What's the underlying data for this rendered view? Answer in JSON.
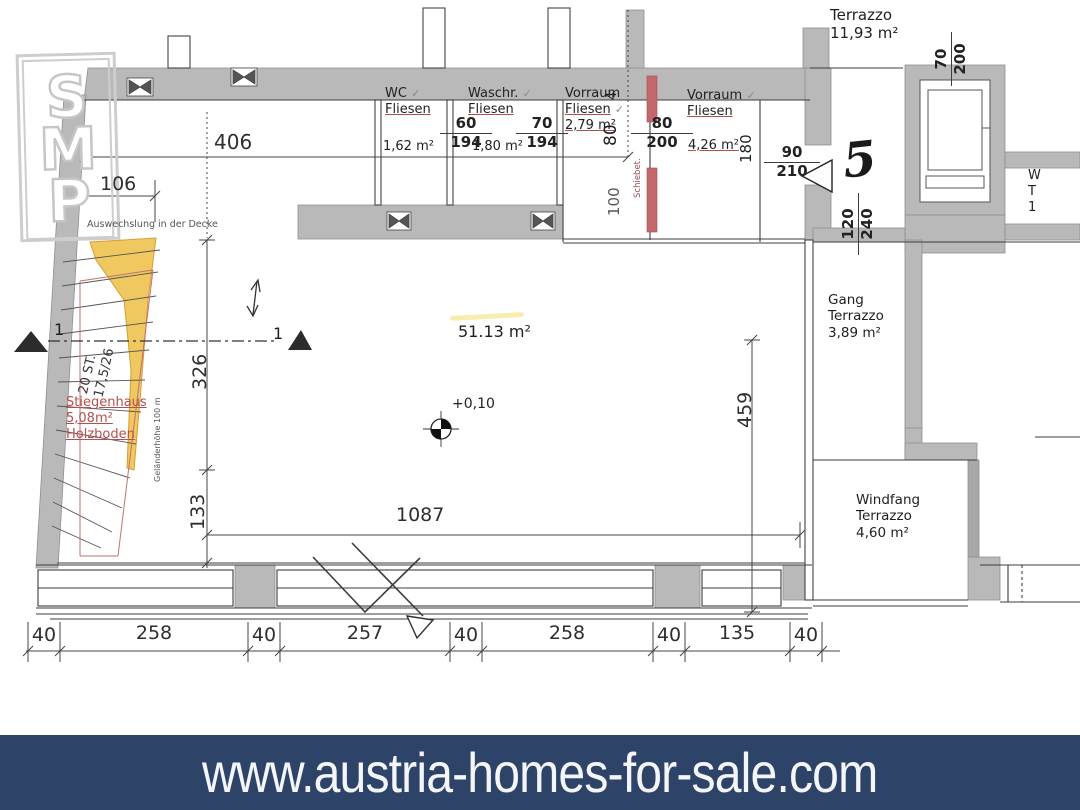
{
  "banner": {
    "url": "www.austria-homes-for-sale.com"
  },
  "logo": {
    "letters": [
      "S",
      "M",
      "P"
    ]
  },
  "rooms": {
    "wc": {
      "name": "WC",
      "floor": "Fliesen",
      "area": "1,62 m²"
    },
    "wasch": {
      "name": "Waschr.",
      "floor": "Fliesen",
      "area": "1,80 m²"
    },
    "vorraum1": {
      "name": "Vorraum",
      "floor": "Fliesen",
      "area": "2,79 m²"
    },
    "vorraum2": {
      "name": "Vorraum",
      "floor": "Fliesen",
      "area": "4,26 m²"
    },
    "terrazzo": {
      "name": "Terrazzo",
      "area": "11,93 m²"
    },
    "gang": {
      "name": "Gang",
      "floor": "Terrazzo",
      "area": "3,89 m²"
    },
    "windfang": {
      "name": "Windfang",
      "floor": "Terrazzo",
      "area": "4,60 m²"
    },
    "main": {
      "area": "51.13 m²",
      "level": "+0,10"
    },
    "stiegenhaus": {
      "name": "Stiegenhaus",
      "area": "5,08m²",
      "floor": "Holzboden",
      "steps": "20 ST.",
      "step_ratio": "17,5/26",
      "railing": "Geländerhöhe 100 m"
    },
    "right_clipped": {
      "l1": "W",
      "l2": "T",
      "l3": "1"
    }
  },
  "annotations": {
    "ceiling_note": "Auswechslung in der Decke",
    "sliding_door": "Schiebet.",
    "section_left": "1",
    "section_right": "1",
    "handwritten": "5",
    "check": "✓"
  },
  "dims": {
    "d406": "406",
    "d106": "106",
    "d326": "326",
    "d133": "133",
    "d1087": "1087",
    "d459": "459",
    "chain": [
      "40",
      "258",
      "40",
      "257",
      "40",
      "258",
      "40",
      "135",
      "40"
    ],
    "o60": {
      "w": "60",
      "h": "194"
    },
    "o70": {
      "w": "70",
      "h": "194"
    },
    "o80": {
      "w": "80",
      "h": "200"
    },
    "o90": {
      "w": "90",
      "h": "210"
    },
    "o70b": {
      "w": "70",
      "h": "200"
    },
    "o120": {
      "w": "120",
      "h": "240"
    },
    "wall80": "80",
    "wall4": "4",
    "pocket100": "100",
    "depth180": "180"
  },
  "colors": {
    "banner_bg": "#2e4368",
    "wall_gray": "#b9b9b9",
    "door_red": "#c4686c",
    "stair_yellow": "#efc95f"
  }
}
